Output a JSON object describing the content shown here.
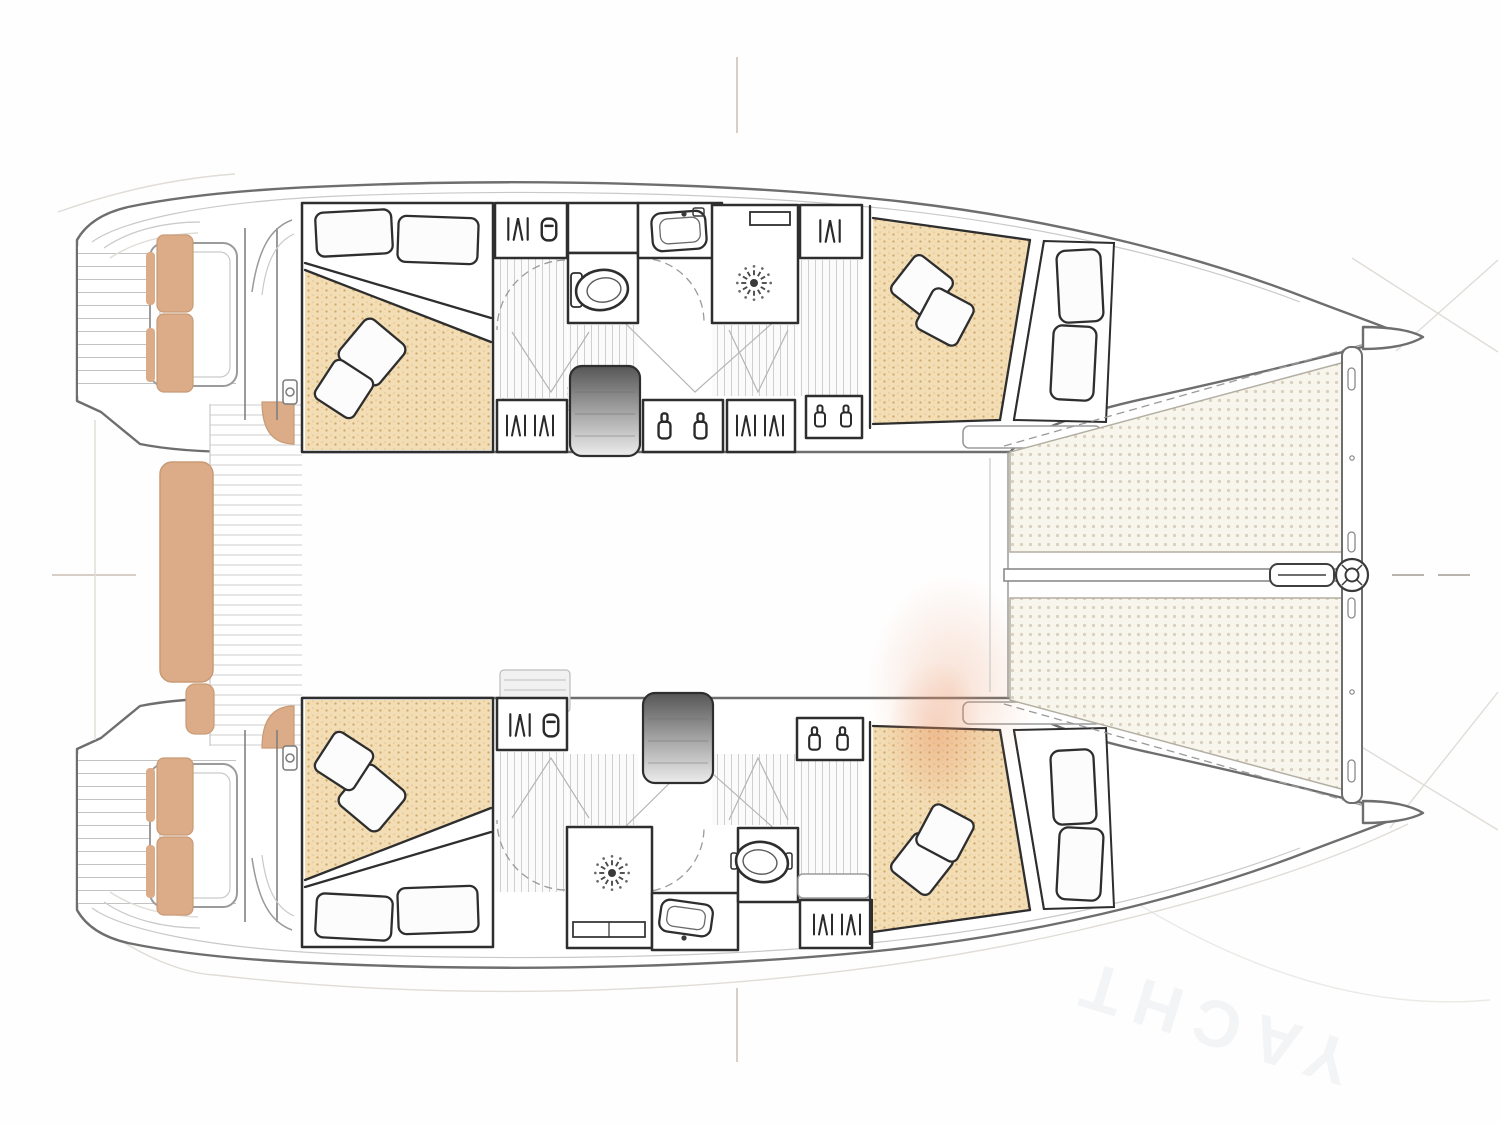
{
  "meta": {
    "title": "Catamaran interior layout – top-down deck plan",
    "type": "boat-floor-plan",
    "view": "top-down",
    "bow_direction": "right",
    "hulls": 2
  },
  "watermark": {
    "text": "YACHT"
  },
  "colors": {
    "bedding": "#f2ddb5",
    "bedding_dot": "#d2a869",
    "bedding_dot2": "#e7cb9a",
    "cushion": "#dcab87",
    "cushion_edge": "#c89b76",
    "tramp_bg": "#f8f5ed",
    "tramp_dot": "#d9d0bd",
    "accent_blob": "#e98f60",
    "watermark": "#76808f",
    "wall": "#2e2e2e",
    "hull_line": "#6e6e6e"
  },
  "rooms": [
    {
      "id": "port-aft-cabin",
      "name": "Aft double cabin (port hull)"
    },
    {
      "id": "port-bathroom",
      "name": "Bathroom with toilet and washbasin (port hull)"
    },
    {
      "id": "port-shower",
      "name": "Shower room (port hull)"
    },
    {
      "id": "port-forward-cabin",
      "name": "Forward double cabin (port hull)"
    },
    {
      "id": "starboard-aft-cabin",
      "name": "Aft double cabin (starboard hull)"
    },
    {
      "id": "starboard-shower",
      "name": "Shower room (starboard hull)"
    },
    {
      "id": "starboard-bathroom",
      "name": "Bathroom with toilet and washbasin (starboard hull)"
    },
    {
      "id": "starboard-forward-cabin",
      "name": "Forward double cabin (starboard hull)"
    },
    {
      "id": "saloon",
      "name": "Saloon / bridgedeck"
    },
    {
      "id": "cockpit",
      "name": "Aft cockpit with bench seat"
    },
    {
      "id": "port-swim-platform",
      "name": "Swim platform and transom steps (port)"
    },
    {
      "id": "starboard-swim-platform",
      "name": "Swim platform and transom steps (starboard)"
    },
    {
      "id": "port-trampoline",
      "name": "Bow trampoline net (port)"
    },
    {
      "id": "starboard-trampoline",
      "name": "Bow trampoline net (starboard)"
    },
    {
      "id": "foredeck",
      "name": "Foredeck, crossbeam and bowsprit with furler"
    }
  ],
  "fixtures": {
    "double_beds": 4,
    "decorative_pillows_per_bed": 2,
    "toilets": 2,
    "washbasins": 2,
    "showers": 2,
    "wardrobes": 7,
    "companionway_stairs": 2,
    "trampolines": 2,
    "swim_platforms": 2,
    "cockpit_benches": 1,
    "winches": 2
  },
  "icons": [
    "hanger-icon",
    "bottle-icon",
    "container-icon",
    "shower-head-icon",
    "toilet-icon",
    "sink-icon",
    "winch-icon",
    "furler-icon",
    "stairs-icon"
  ]
}
